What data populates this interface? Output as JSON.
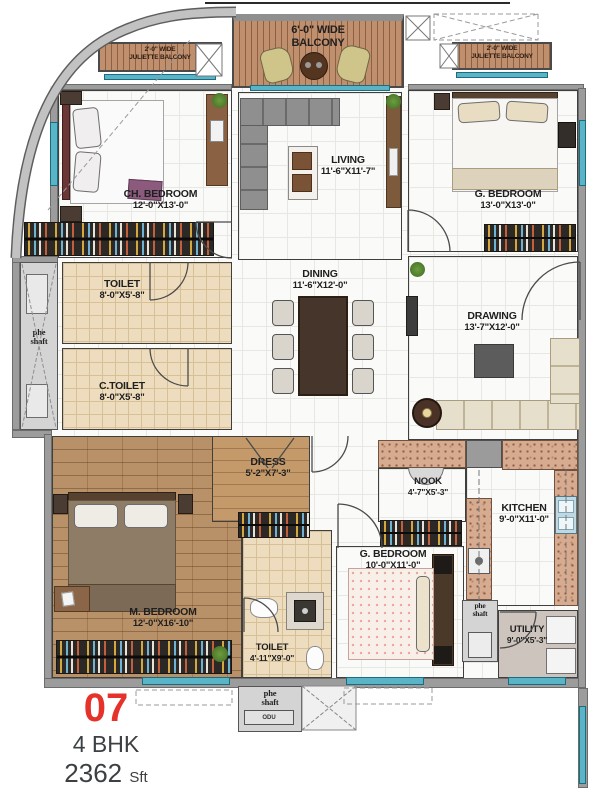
{
  "legend": {
    "unit_number": "07",
    "unit_type": "4 BHK",
    "area_value": "2362",
    "area_unit": "Sft"
  },
  "balconies": {
    "main": {
      "line1": "6'-0\" WIDE",
      "line2": "BALCONY"
    },
    "juliette_left": {
      "line1": "2'-0\" WIDE",
      "line2": "JULIETTE BALCONY"
    },
    "juliette_right": {
      "line1": "2'-0\" WIDE",
      "line2": "JULIETTE BALCONY"
    }
  },
  "rooms": {
    "ch_bedroom": {
      "name": "CH. BEDROOM",
      "dim": "12'-0\"X13'-0\""
    },
    "living": {
      "name": "LIVING",
      "dim": "11'-6\"X11'-7\""
    },
    "g_bedroom_top": {
      "name": "G. BEDROOM",
      "dim": "13'-0\"X13'-0\""
    },
    "toilet_top": {
      "name": "TOILET",
      "dim": "8'-0\"X5'-8\""
    },
    "c_toilet": {
      "name": "C.TOILET",
      "dim": "8'-0\"X5'-8\""
    },
    "dining": {
      "name": "DINING",
      "dim": "11'-6\"X12'-0\""
    },
    "drawing": {
      "name": "DRAWING",
      "dim": "13'-7\"X12'-0\""
    },
    "dress": {
      "name": "DRESS",
      "dim": "5'-2\"X7'-3\""
    },
    "m_bedroom": {
      "name": "M. BEDROOM",
      "dim": "12'-0\"X16'-10\""
    },
    "toilet_m": {
      "name": "TOILET",
      "dim": "4'-11\"X9'-0\""
    },
    "g_bedroom_bottom": {
      "name": "G. BEDROOM",
      "dim": "10'-0\"X11'-0\""
    },
    "nook": {
      "name": "NOOK",
      "dim": "4'-7\"X5'-3\""
    },
    "kitchen": {
      "name": "KITCHEN",
      "dim": "9'-0\"X11'-0\""
    },
    "utility": {
      "name": "UTILITY",
      "dim": "9'-0\"X5'-3\""
    }
  },
  "shafts": {
    "left": {
      "line1": "phe",
      "line2": "shaft"
    },
    "bottom": {
      "line1": "phe",
      "line2": "shaft"
    },
    "right": {
      "line1": "phe",
      "line2": "shaft"
    }
  },
  "equipment": {
    "odu": "ODU"
  },
  "colors": {
    "accent_red": "#e5332b",
    "window_teal": "#58b4c6",
    "wall_gray": "#9c9c9c",
    "wood_floor": "#b4895c",
    "granite": "#d7ab8f"
  }
}
